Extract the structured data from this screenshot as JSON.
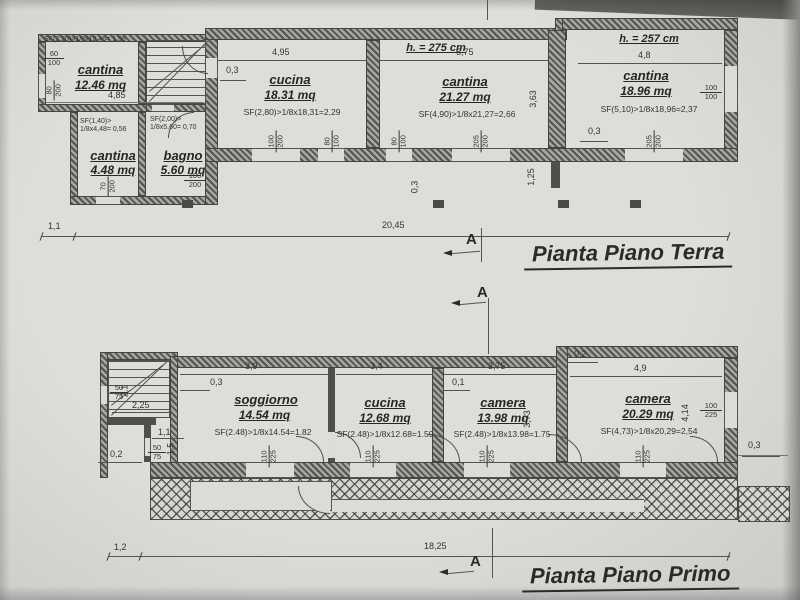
{
  "sheet": {
    "paper": "#d8d7d3",
    "ink": "#3a3a38",
    "wall_hatch": "#55544f"
  },
  "sections": {
    "terra": "A",
    "primo_top": "A",
    "primo_bottom": "A"
  },
  "terra": {
    "title": "Pianta Piano Terra",
    "rooms": {
      "cantina_tl": {
        "name": "cantina",
        "area": "12.46 mq",
        "formula": "SF(2,20)>1/8x12,46= 1,56"
      },
      "cantina_l": {
        "name": "cantina",
        "area": "4.48 mq",
        "formula": "SF(1,40)> 1/8x4,48= 0,56"
      },
      "bagno": {
        "name": "bagno",
        "area": "5.60 mq",
        "formula": "SF(2,00)> 1/8x5,60= 0,70"
      },
      "cucina": {
        "name": "cucina",
        "area": "18.31 mq",
        "formula": "SF(2,80)>1/8x18,31=2,29"
      },
      "cantina_m": {
        "name": "cantina",
        "area": "21.27 mq",
        "formula": "SF(4,90)>1/8x21,27=2,66",
        "height": "h. = 275 cm"
      },
      "cantina_r": {
        "name": "cantina",
        "area": "18.96 mq",
        "formula": "SF(5,10)>1/8x18,96=2,37",
        "height": "h. = 257 cm"
      }
    },
    "dims": {
      "annex_width": "4,85",
      "cucina_width": "4,95",
      "cucina_offset": "0,3",
      "cantina_m_width": "5,75",
      "cantina_m_depth": "3,63",
      "cantina_r_width": "4,8",
      "cantina_r_offset": "0,3",
      "wall_offset": "0,3",
      "wall_drop": "1,25",
      "left": "1,1",
      "total": "20,45"
    },
    "markers": {
      "w60_100": {
        "t": "60",
        "b": "100"
      },
      "w80_200": {
        "t": "80",
        "b": "200"
      },
      "w70_200": {
        "t": "70",
        "b": "200"
      },
      "w100_200_bagno": {
        "t": "100",
        "b": "200"
      },
      "w100_200": {
        "t": "100",
        "b": "200"
      },
      "w80_100_a": {
        "t": "80",
        "b": "100"
      },
      "w80_100_b": {
        "t": "80",
        "b": "100"
      },
      "w205_200_a": {
        "t": "205",
        "b": "200"
      },
      "w205_200_b": {
        "t": "205",
        "b": "200"
      },
      "w100_100": {
        "t": "100",
        "b": "100"
      }
    }
  },
  "primo": {
    "title": "Pianta Piano Primo",
    "rooms": {
      "soggiorno": {
        "name": "soggiorno",
        "area": "14.54 mq",
        "formula": "SF(2.48)>1/8x14.54=1.82"
      },
      "cucina": {
        "name": "cucina",
        "area": "12.68 mq",
        "formula": "SF(2.48)>1/8x12.68=1.59"
      },
      "camera_m": {
        "name": "camera",
        "area": "13.98 mq",
        "formula": "SF(2.48)>1/8x13.98=1.75"
      },
      "camera_r": {
        "name": "camera",
        "area": "20.29 mq",
        "formula": "SF(4,73)>1/8x20,29=2,54"
      }
    },
    "dims": {
      "soggiorno_width": "3,9",
      "soggiorno_offset": "0,3",
      "cucina_width": "3,4",
      "camera_m_width": "3,75",
      "camera_m_offset": "0,1",
      "camera_m_depth": "3,73",
      "camera_r_offset": "0,2",
      "camera_r_width": "4,9",
      "camera_r_depth": "4,14",
      "right_offset": "0,3",
      "stair_width": "2,25",
      "stair_depth": "2,1",
      "hall_width": "1,1",
      "hall_depth": "1,5",
      "entry_offset": "0,2",
      "base_left": "1,2",
      "base_total": "18,25"
    },
    "markers": {
      "w50_75_a": {
        "t": "50",
        "b": "75"
      },
      "w50_75_b": {
        "t": "50",
        "b": "75"
      },
      "w110_225_a": {
        "t": "110",
        "b": "225"
      },
      "w110_225_b": {
        "t": "110",
        "b": "225"
      },
      "w110_225_c": {
        "t": "110",
        "b": "225"
      },
      "w110_225_d": {
        "t": "110",
        "b": "225"
      },
      "w100_225": {
        "t": "100",
        "b": "225"
      }
    }
  }
}
